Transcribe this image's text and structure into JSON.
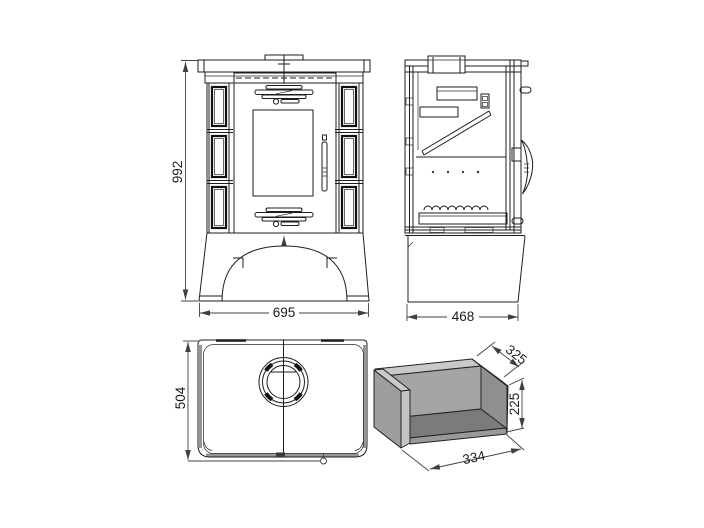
{
  "drawing": {
    "title": "stove-technical-drawing",
    "front_view": {
      "height": "992",
      "width": "695"
    },
    "side_view": {
      "depth": "468"
    },
    "top_view": {
      "depth": "504"
    },
    "firebox": {
      "depth": "325",
      "height": "225",
      "width": "334"
    }
  },
  "colors": {
    "background": "#ffffff",
    "line": "#1d1d1d",
    "dimension_line": "#404040",
    "face_light": "#c9c9c9",
    "face_mid": "#a5a5a5",
    "face_inner": "#8f8f8f",
    "face_floor": "#7b7b7b",
    "face_left": "#9e9e9e",
    "shadow_edge": "#969696"
  }
}
